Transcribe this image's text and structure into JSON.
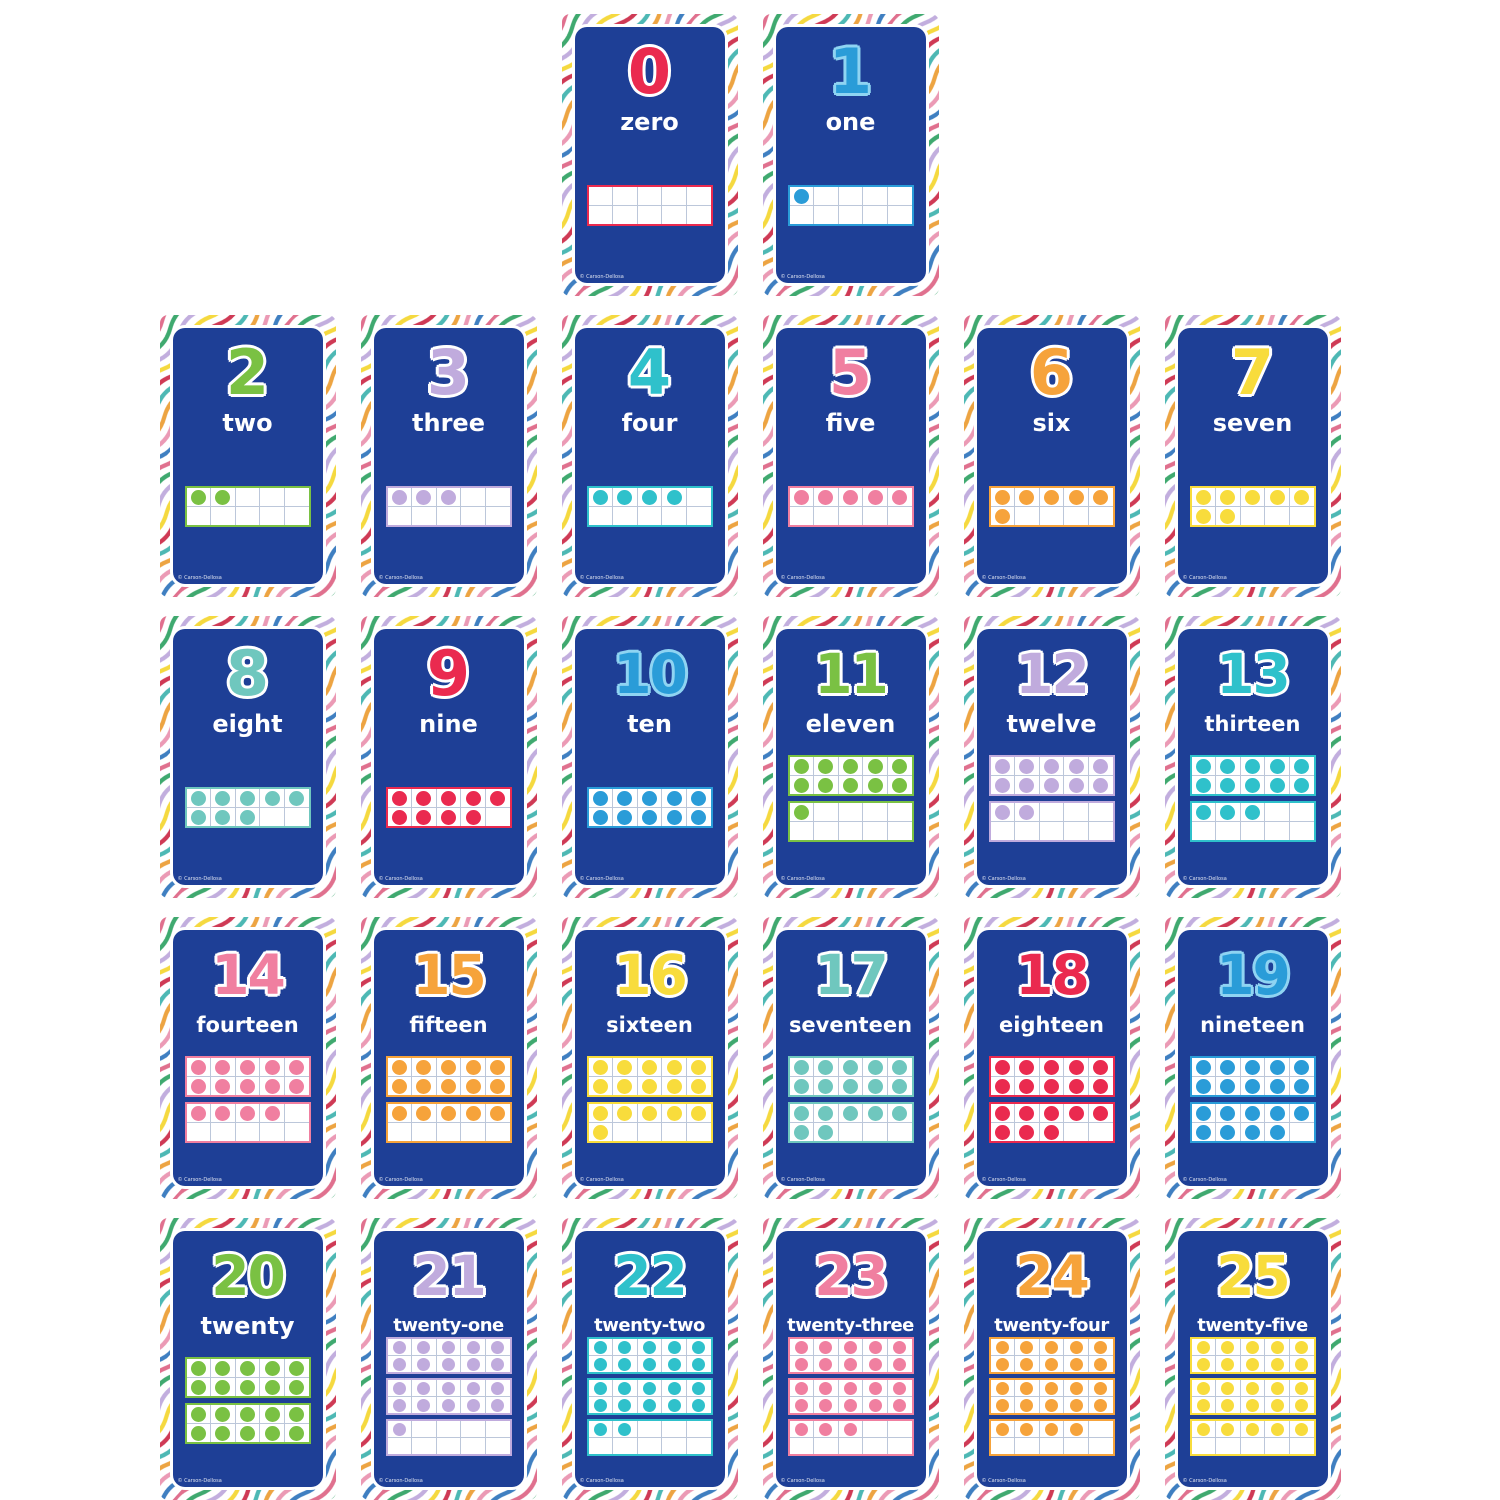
{
  "product": {
    "description": "Number flashcards 0 to 25 with ten-frame dot grids on rainbow wavy-stripe borders",
    "copyright": "© Carson-Dellosa"
  },
  "style": {
    "panel_blue": "#1e3f96",
    "frame_grid_line_color": "#bcc7da",
    "frame_background": "#ffffff",
    "default_number_outline": "#ffffff",
    "blue_number_outline": "#8fd4f2",
    "stripe_colors": [
      "#e0708e",
      "#3fa96f",
      "#c2aede",
      "#f5d93f",
      "#cf3a55",
      "#4db8b4",
      "#eda442",
      "#eb9ab5",
      "#3f7fc1"
    ]
  },
  "layout": {
    "rows": [
      [
        0,
        1
      ],
      [
        2,
        3,
        4,
        5,
        6,
        7
      ],
      [
        8,
        9,
        10,
        11,
        12,
        13
      ],
      [
        14,
        15,
        16,
        17,
        18,
        19
      ],
      [
        20,
        21,
        22,
        23,
        24,
        25
      ]
    ]
  },
  "cards": [
    {
      "number": "0",
      "word": "zero",
      "color": "#ea2a4f",
      "dot_count": 0,
      "frames": [
        0
      ]
    },
    {
      "number": "1",
      "word": "one",
      "color": "#2a9cd8",
      "outline": "#8fd4f2",
      "dot_count": 1,
      "frames": [
        1
      ]
    },
    {
      "number": "2",
      "word": "two",
      "color": "#7ac143",
      "dot_count": 2,
      "frames": [
        2
      ]
    },
    {
      "number": "3",
      "word": "three",
      "color": "#c0abdd",
      "dot_count": 3,
      "frames": [
        3
      ]
    },
    {
      "number": "4",
      "word": "four",
      "color": "#2fc1cb",
      "dot_count": 4,
      "frames": [
        4
      ]
    },
    {
      "number": "5",
      "word": "five",
      "color": "#f07fa0",
      "dot_count": 5,
      "frames": [
        5
      ]
    },
    {
      "number": "6",
      "word": "six",
      "color": "#f6a33b",
      "dot_count": 6,
      "frames": [
        6
      ]
    },
    {
      "number": "7",
      "word": "seven",
      "color": "#f8dc3c",
      "dot_count": 7,
      "frames": [
        7
      ]
    },
    {
      "number": "8",
      "word": "eight",
      "color": "#6fc7be",
      "dot_count": 8,
      "frames": [
        8
      ]
    },
    {
      "number": "9",
      "word": "nine",
      "color": "#ea2a4f",
      "dot_count": 9,
      "frames": [
        9
      ]
    },
    {
      "number": "10",
      "word": "ten",
      "color": "#2a9cd8",
      "outline": "#8fd4f2",
      "dot_count": 10,
      "frames": [
        10
      ]
    },
    {
      "number": "11",
      "word": "eleven",
      "color": "#7ac143",
      "dot_count": 11,
      "frames": [
        10,
        1
      ]
    },
    {
      "number": "12",
      "word": "twelve",
      "color": "#c0abdd",
      "dot_count": 12,
      "frames": [
        10,
        2
      ]
    },
    {
      "number": "13",
      "word": "thirteen",
      "color": "#2fc1cb",
      "dot_count": 13,
      "frames": [
        10,
        3
      ]
    },
    {
      "number": "14",
      "word": "fourteen",
      "color": "#f07fa0",
      "dot_count": 14,
      "frames": [
        10,
        4
      ]
    },
    {
      "number": "15",
      "word": "fifteen",
      "color": "#f6a33b",
      "dot_count": 15,
      "frames": [
        10,
        5
      ]
    },
    {
      "number": "16",
      "word": "sixteen",
      "color": "#f8dc3c",
      "dot_count": 16,
      "frames": [
        10,
        6
      ]
    },
    {
      "number": "17",
      "word": "seventeen",
      "color": "#6fc7be",
      "dot_count": 17,
      "frames": [
        10,
        7
      ]
    },
    {
      "number": "18",
      "word": "eighteen",
      "color": "#ea2a4f",
      "dot_count": 18,
      "frames": [
        10,
        8
      ]
    },
    {
      "number": "19",
      "word": "nineteen",
      "color": "#2a9cd8",
      "outline": "#8fd4f2",
      "dot_count": 19,
      "frames": [
        10,
        9
      ]
    },
    {
      "number": "20",
      "word": "twenty",
      "color": "#7ac143",
      "dot_count": 20,
      "frames": [
        10,
        10
      ]
    },
    {
      "number": "21",
      "word": "twenty-one",
      "color": "#c0abdd",
      "dot_count": 21,
      "frames": [
        10,
        10,
        1
      ]
    },
    {
      "number": "22",
      "word": "twenty-two",
      "color": "#2fc1cb",
      "dot_count": 22,
      "frames": [
        10,
        10,
        2
      ]
    },
    {
      "number": "23",
      "word": "twenty-three",
      "color": "#f07fa0",
      "dot_count": 23,
      "frames": [
        10,
        10,
        3
      ]
    },
    {
      "number": "24",
      "word": "twenty-four",
      "color": "#f6a33b",
      "dot_count": 24,
      "frames": [
        10,
        10,
        4
      ]
    },
    {
      "number": "25",
      "word": "twenty-five",
      "color": "#f8dc3c",
      "dot_count": 25,
      "frames": [
        10,
        10,
        5
      ]
    }
  ]
}
